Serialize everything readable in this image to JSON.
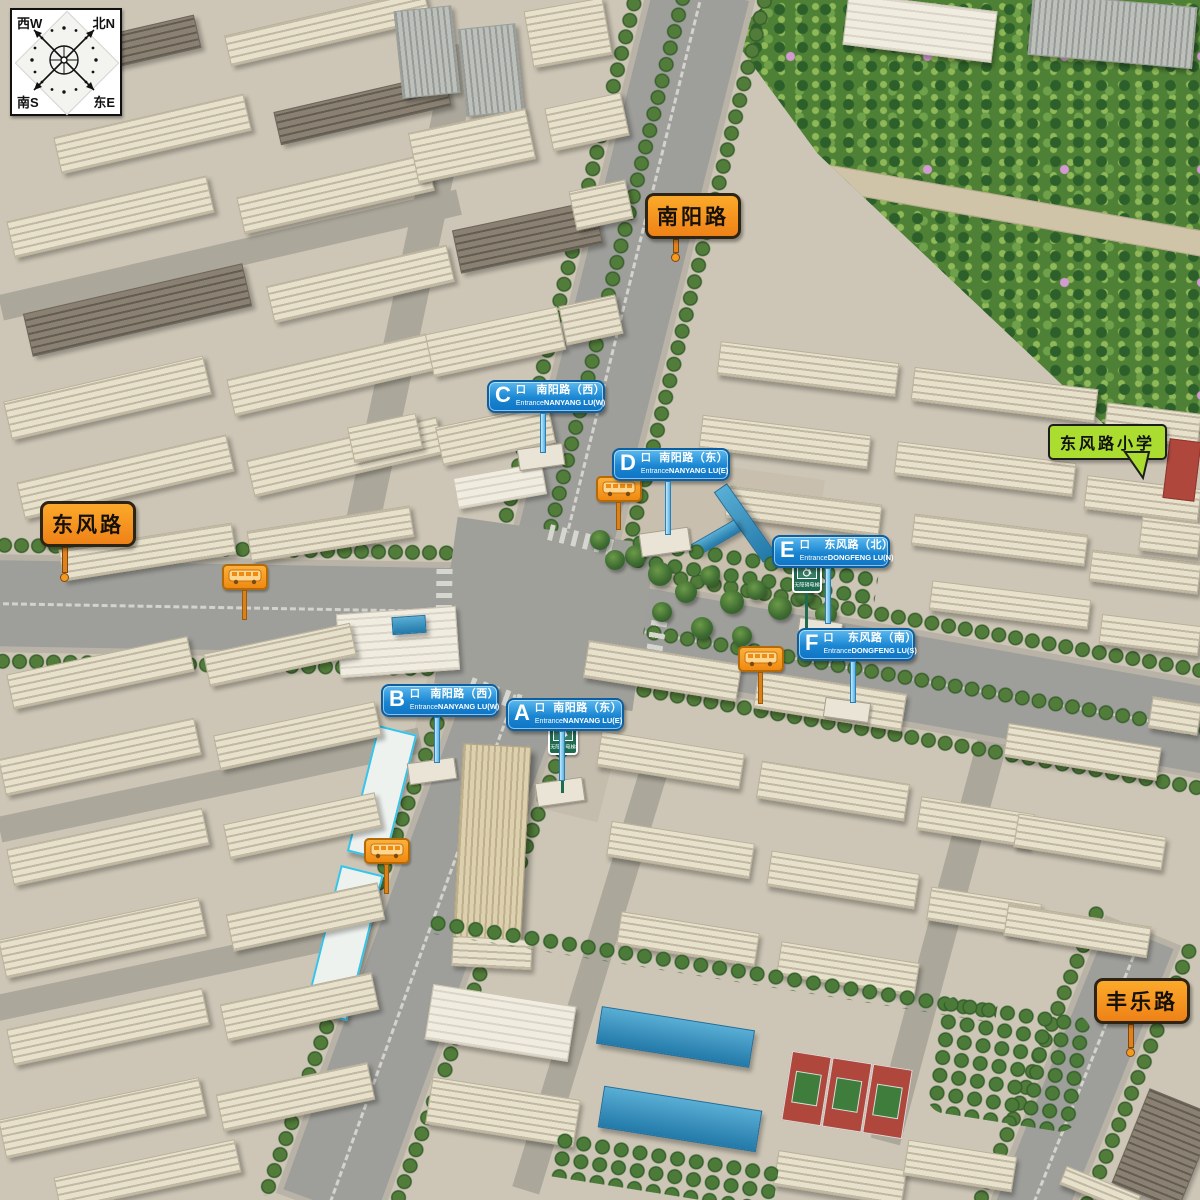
{
  "compass": {
    "nw": "西W",
    "ne": "北N",
    "sw": "南S",
    "se": "东E"
  },
  "road_labels": {
    "nanyang": "南阳路",
    "dongfeng": "东风路",
    "fengle": "丰乐路"
  },
  "poi": {
    "school": "东风路小学"
  },
  "entrances": [
    {
      "letter": "A",
      "kou": "口",
      "cn": "南阳路（东）",
      "en_label": "Entrance",
      "en": "NANYANG LU(E)"
    },
    {
      "letter": "B",
      "kou": "口",
      "cn": "南阳路（西）",
      "en_label": "Entrance",
      "en": "NANYANG LU(W)"
    },
    {
      "letter": "C",
      "kou": "口",
      "cn": "南阳路（西）",
      "en_label": "Entrance",
      "en": "NANYANG LU(W)"
    },
    {
      "letter": "D",
      "kou": "口",
      "cn": "南阳路（东）",
      "en_label": "Entrance",
      "en": "NANYANG LU(E)"
    },
    {
      "letter": "E",
      "kou": "口",
      "cn": "东风路（北）",
      "en_label": "Entrance",
      "en": "DONGFENG LU(N)"
    },
    {
      "letter": "F",
      "kou": "口",
      "cn": "东风路（南）",
      "en_label": "Entrance",
      "en": "DONGFENG LU(S)"
    }
  ],
  "signs": {
    "accessible_elevator": "无障碍电梯"
  },
  "icons": {
    "compass": "compass-rose-icon",
    "bus_stop": "bus-stop-icon",
    "accessibility": "wheelchair-icon"
  },
  "colors": {
    "road_label_bg": "#F7941E",
    "entrance_sign_bg": "#1488D0",
    "school_label_bg": "#ABDC30",
    "accessible_sign_bg": "#1E6B50",
    "park_green": "#4E8136",
    "road_gray": "#9E9E9A",
    "building_beige": "#E7E0CB"
  }
}
